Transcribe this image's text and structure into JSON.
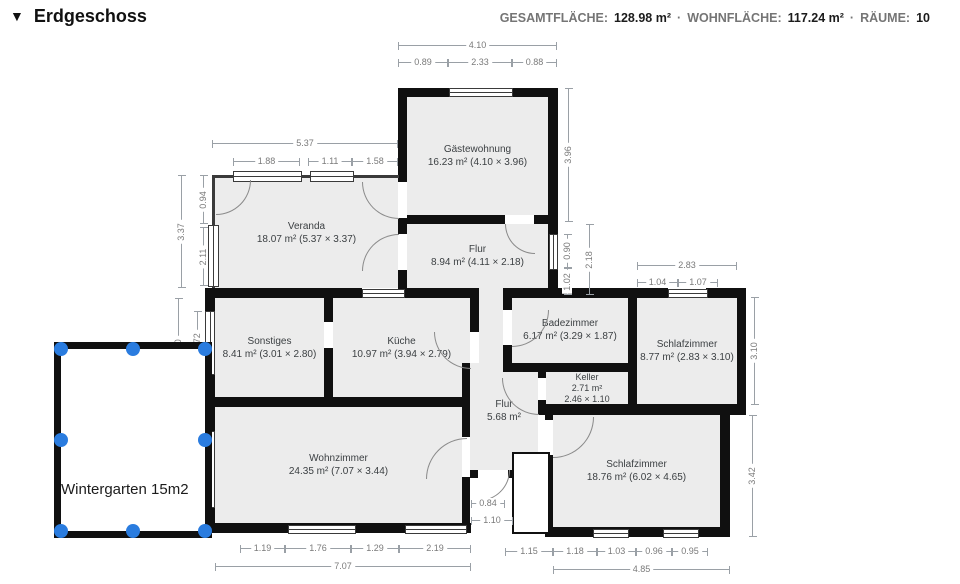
{
  "header": {
    "collapse_icon": "▼",
    "title": "Erdgeschoss",
    "stats": {
      "s1_label": "GESAMTFLÄCHE:",
      "s1_value": "128.98 m²",
      "sep1": "·",
      "s2_label": "WOHNFLÄCHE:",
      "s2_value": "117.24 m²",
      "sep2": "·",
      "s3_label": "RÄUME:",
      "s3_value": "10"
    }
  },
  "rooms": {
    "gaestewohnung": {
      "name": "Gästewohnung",
      "details": "16.23 m² (4.10 × 3.96)"
    },
    "veranda": {
      "name": "Veranda",
      "details": "18.07 m² (5.37 × 3.37)"
    },
    "flur_mitte": {
      "name": "Flur",
      "details": "8.94 m² (4.11 × 2.18)"
    },
    "sonstiges": {
      "name": "Sonstiges",
      "details": "8.41 m² (3.01 × 2.80)"
    },
    "kueche": {
      "name": "Küche",
      "details": "10.97 m² (3.94 × 2.79)"
    },
    "badezimmer": {
      "name": "Badezimmer",
      "details": "6.17 m² (3.29 × 1.87)"
    },
    "schlafzimmer_rechts": {
      "name": "Schlafzimmer",
      "details": "8.77 m² (2.83 × 3.10)"
    },
    "keller": {
      "name": "Keller",
      "details": "2.71 m²",
      "details2": "2.46 × 1.10"
    },
    "flur_klein": {
      "name": "Flur",
      "details": "5.68 m²"
    },
    "wohnzimmer": {
      "name": "Wohnzimmer",
      "details": "24.35 m² (7.07 × 3.44)"
    },
    "schlafzimmer_unten": {
      "name": "Schlafzimmer",
      "details": "18.76 m² (6.02 × 4.65)"
    }
  },
  "wintergarten": {
    "label": "Wintergarten 15m2"
  },
  "colors": {
    "handle_blue": "#2a7cdf",
    "wall": "#101010",
    "room_fill": "#ececec"
  },
  "dims": {
    "gaeste_breite": "4.10",
    "gaeste_links": "0.89",
    "gaeste_fenster": "2.33",
    "gaeste_rechts": "0.88",
    "gaeste_hoehe": "3.96",
    "veranda_breite": "5.37",
    "veranda_f1": "1.88",
    "veranda_f2": "1.11",
    "veranda_f3": "1.58",
    "veranda_hoehe": "3.37",
    "veranda_tuer": "0.94",
    "veranda_fenster": "2.11",
    "west_sonstiges": "2.80",
    "west_fenster1": "1.72",
    "west_wohnzimmer": "3.44",
    "west_fenster2": "1.97",
    "west_unten": "0.97",
    "flur_fenster": "0.90",
    "flur_unten": "1.02",
    "flur_hoehe": "2.18",
    "schlafr_breite": "2.83",
    "schlafr_links": "1.04",
    "schlafr_fenster": "1.07",
    "schlafr_hoehe": "3.10",
    "schlafu_hoehe": "3.42",
    "sued1": "1.19",
    "sued2": "1.76",
    "sued3": "1.29",
    "sued4": "2.19",
    "wohn_breite": "7.07",
    "sued5": "1.15",
    "sued6": "1.18",
    "sued7": "1.03",
    "sued8": "0.96",
    "sued9": "0.95",
    "schlafu_breite": "4.85",
    "eingang_tuer": "0.84",
    "eingang_breite": "1.10"
  }
}
